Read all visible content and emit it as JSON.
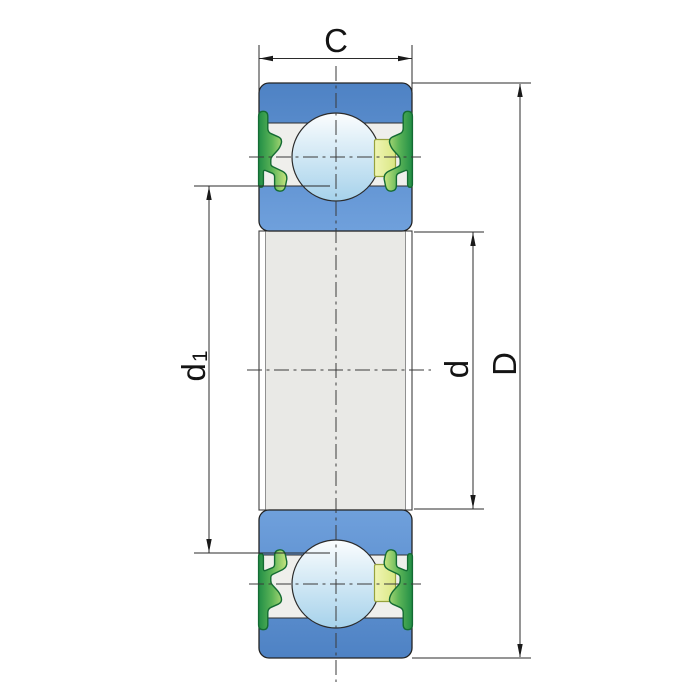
{
  "dimensions": {
    "width": {
      "label": "C"
    },
    "outer_diameter": {
      "label": "D"
    },
    "bore_diameter": {
      "label": "d"
    },
    "recess_diameter": {
      "label": "d",
      "sub": "1"
    }
  },
  "colors": {
    "ring_blue_dark": "#4E82C4",
    "ring_blue_light": "#6FA0DC",
    "raceway_white": "#EFEFEC",
    "bore_gray": "#E9E9E6",
    "ball_highlight": "#FBFDFE",
    "ball_shade": "#A6D2EB",
    "seal_dark_green": "#1F8C45",
    "seal_light_green": "#D8EC85",
    "seal_outline": "#146B33",
    "cage_fill": "#E6EFA0",
    "cage_outline": "#96A23E",
    "line": "#2B2B2B"
  }
}
